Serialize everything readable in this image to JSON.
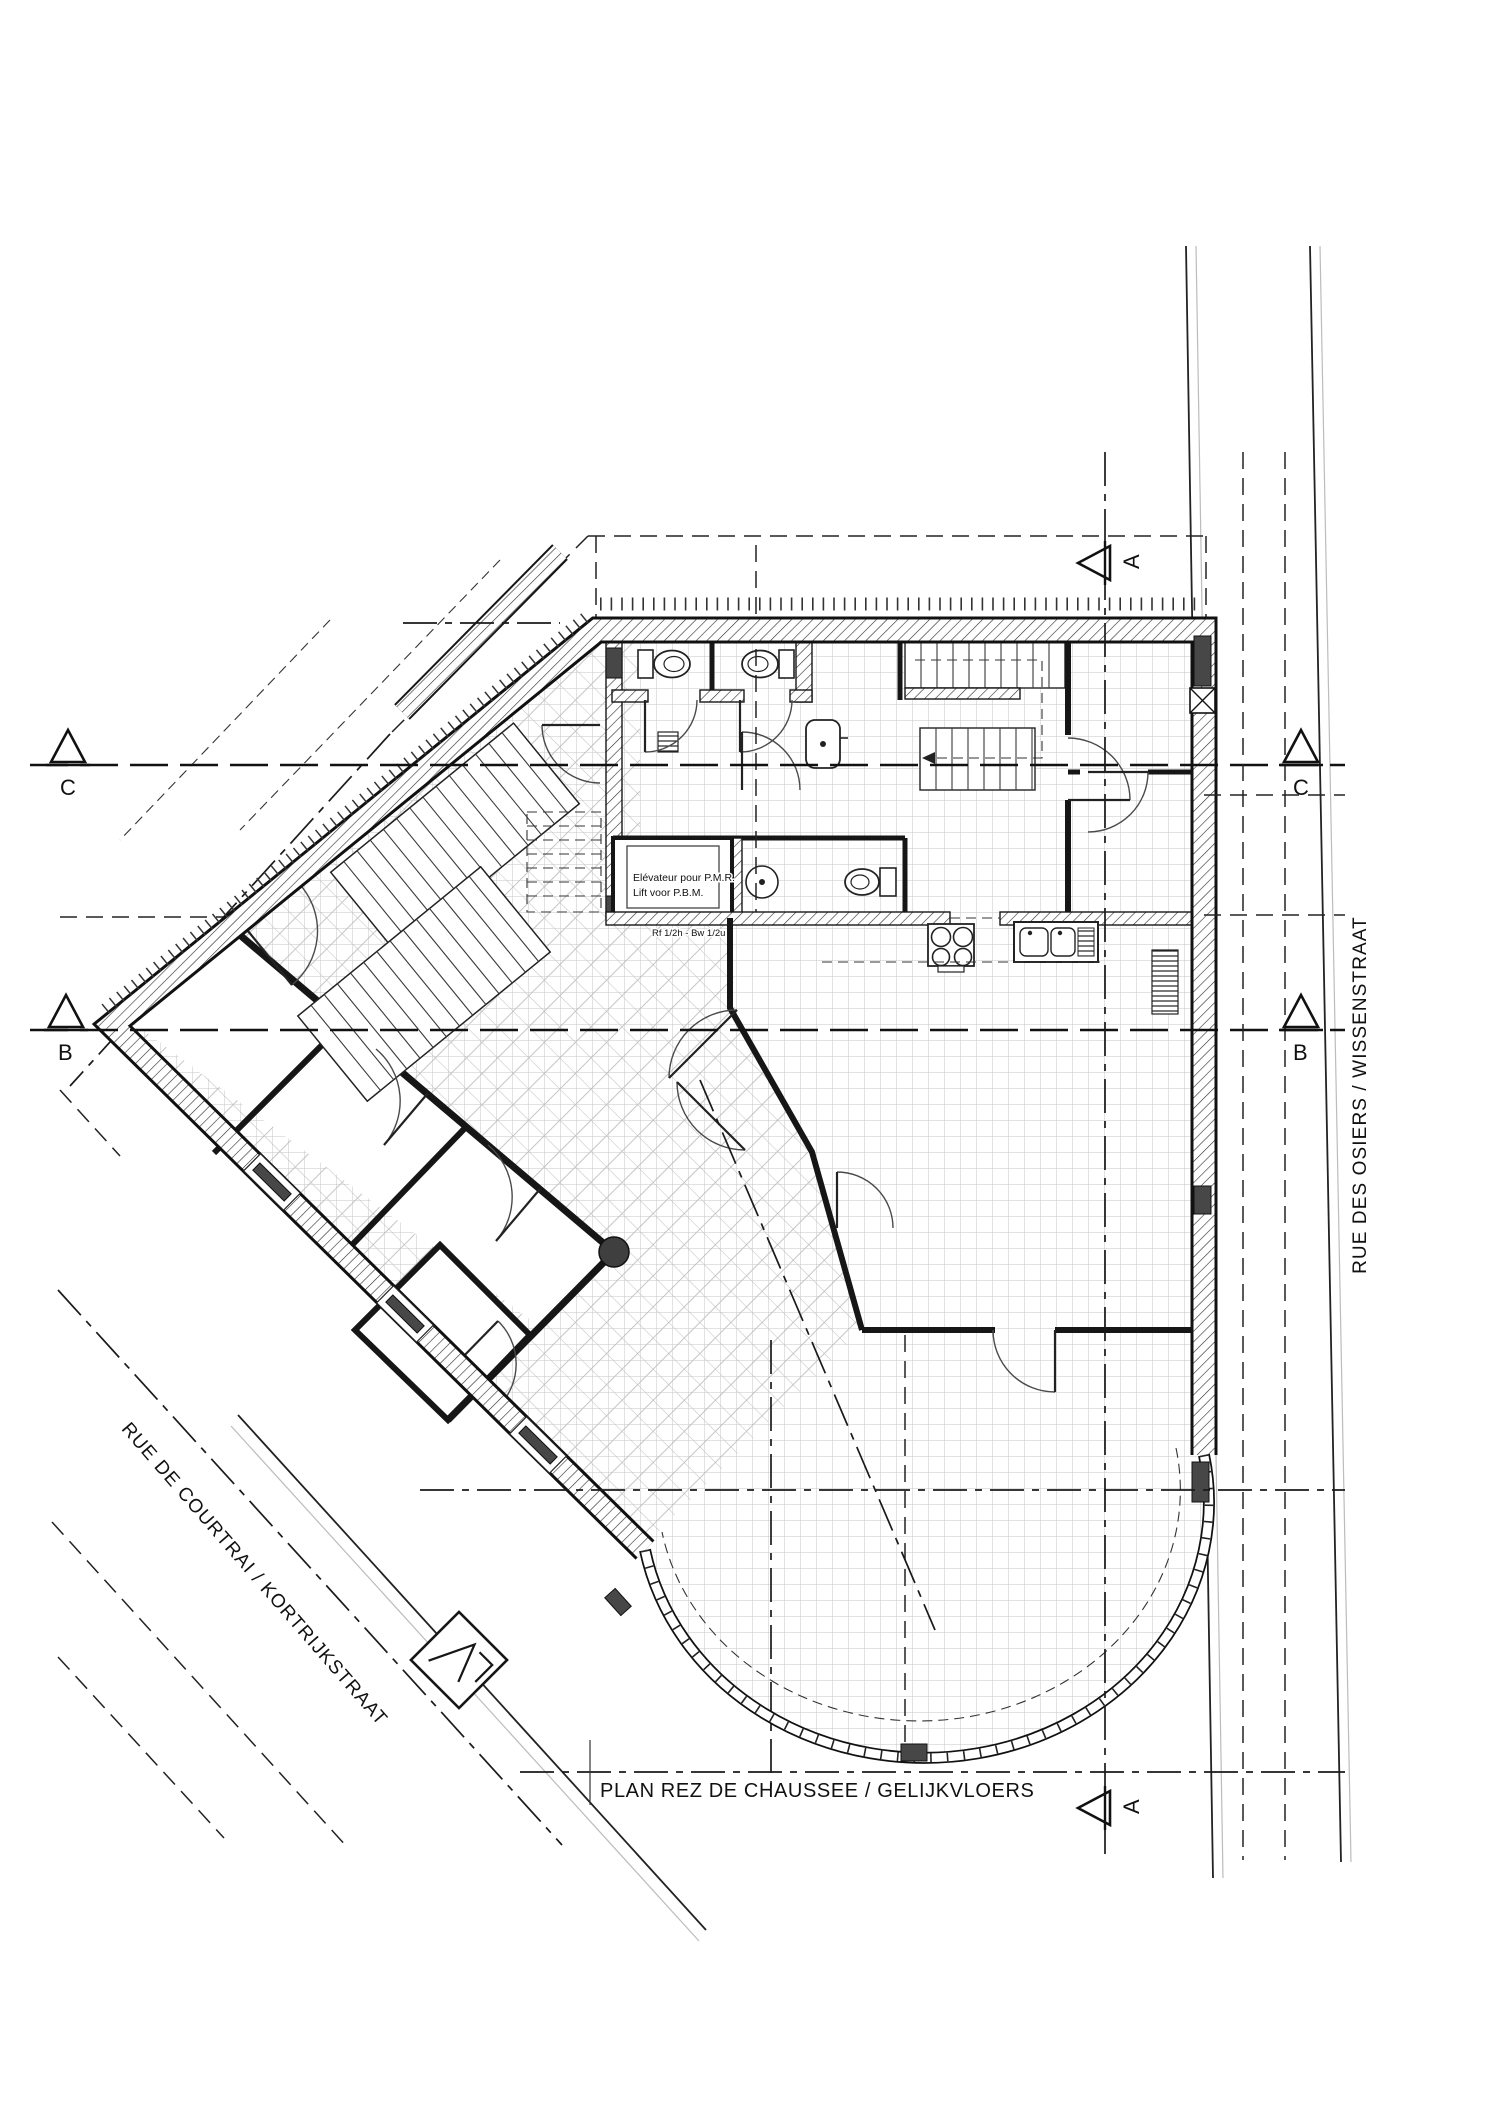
{
  "drawing": {
    "title": "PLAN REZ DE CHAUSSEE / GELIJKVLOERS",
    "streets": {
      "right_vertical": "RUE DES OSIERS / WISSENSTRAAT",
      "bottom_left_diagonal": "RUE DE COURTRAI / KORTRIJKSTRAAT"
    },
    "annotations": {
      "elevator_line1": "Elévateur pour P.M.R.",
      "elevator_line2": "Lift voor P.B.M.",
      "fire_rating": "Rf 1/2h - Bw 1/2u"
    },
    "section_markers": {
      "a": "A",
      "b": "B",
      "c": "C"
    },
    "colors": {
      "ink": "#1a1a1a",
      "tile_grid": "#c6c6c6",
      "wall_hatch": "#2b2b2b",
      "dark_fill": "#474747",
      "street_gray": "#bcbcbc",
      "paper": "#ffffff"
    }
  }
}
